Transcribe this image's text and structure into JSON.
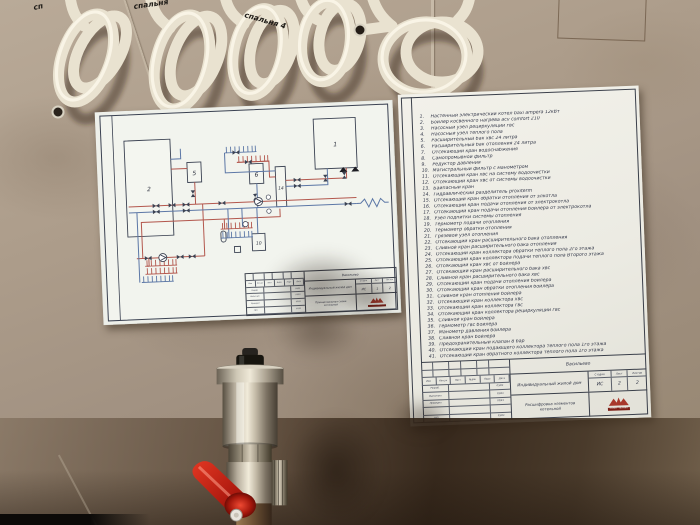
{
  "photo": {
    "cable_labels": [
      "сп",
      "спальня",
      "спальня 4"
    ]
  },
  "colors": {
    "pipe_hot": "#b3574d",
    "pipe_cold": "#5c77a6",
    "schematic_line": "#3b4252",
    "handle_red": "#c0261a",
    "logo_red": "#a8382c",
    "paper": "#efefe9",
    "tile": "#ab9c8a"
  },
  "left_doc": {
    "schematic_labels": {
      "b1": "1",
      "b2": "2",
      "b5": "5",
      "b6": "6",
      "b10": "10",
      "b14": "14"
    },
    "titleblock": {
      "project": "Васильево",
      "object": "Индивидуальный жилой дом",
      "doc_title": "Принципиальная схема котельной",
      "stage_label": "Стадия",
      "sheet_label": "Лист",
      "sheets_label": "Листов",
      "stage": "ИС",
      "sheet": "1",
      "sheets": "2",
      "header_cols": [
        "Изм",
        "Кол.уч",
        "Лист",
        "№док",
        "Подп",
        "Дата"
      ],
      "rows": [
        {
          "role": "Разраб.",
          "date": "03/23"
        },
        {
          "role": "Выполнил",
          "date": "03/23"
        },
        {
          "role": "Проверил",
          "date": "03/23"
        },
        {
          "role": "ГИП",
          "date": "03/23"
        }
      ],
      "logo": "САНКТ-ТЕХНИК"
    }
  },
  "right_doc": {
    "items": [
      "Настенный электрический котел baxi ampera 12кВт",
      "Бойлер косвенного нагрева acv comfort 210",
      "Насосный узел рециркуляции гвс",
      "Насосный узел теплого пола",
      "Расширительный бак хвс 24 литра",
      "Расширительный бак отопления 24 литра",
      "Отсекающий кран водоснабжения",
      "Самопромывной фильтр",
      "Редуктор давления",
      "Магистральный фильтр с манометром",
      "Отсекающий кран хвс на систему водоочистки",
      "Отсекающий кран хвс от системы водоочистки",
      "Байпасный кран",
      "Гидравлический разделитель proxiterm",
      "Отсекающий кран обратки отопления от элкотла",
      "Отсекающий кран подачи отопления от электрокотла",
      "Отсекающий кран подачи отопления бойлера от электрокотла",
      "Узел подпитки системы отопления",
      "Термометр подачи отопления",
      "Термометр обратки отопления",
      "Грязевой узел отопления",
      "Отсекающий кран расширительного бака отопления",
      "Сливной кран расширительного бака отопления",
      "Отсекающий кран коллектора обратки теплого пола 2го этажа",
      "Отсекающий кран коллектора подачи теплого пола Второго этажа",
      "Отсекающий кран хвс от бойлера",
      "Отсекающий кран расширительного бака хвс",
      "Сливной кран расширительного бака хвс",
      "Отсекающий кран подачи отопления бойлера",
      "Отсекающий кран обратки отопления бойлера",
      "Сливной кран отопления бойлера",
      "Отсекающий кран коллектора хвс",
      "Отсекающий кран коллектора гвс",
      "Отсекающий кран коллектора рециркуляции гвс",
      "Сливной кран бойлера",
      "Термометр гвс бойлера",
      "Манометр давления бойлера",
      "Сливной кран бойлера",
      "Предохранительный клапан 8 бар",
      "Отсекающий кран подающего коллектора теплого пола 1го этажа",
      "Отсекающий кран обратного коллектора теплого пола 1го этажа"
    ],
    "titleblock": {
      "project": "Васильево",
      "object": "Индивидуальный жилой дом",
      "doc_title": "Расшифровка элементов котельной",
      "stage_label": "Стадия",
      "sheet_label": "Лист",
      "sheets_label": "Листов",
      "stage": "ИС",
      "sheet": "2",
      "sheets": "2",
      "header_cols": [
        "Изм",
        "Кол.уч",
        "Лист",
        "№док",
        "Подп",
        "Дата"
      ],
      "rows": [
        {
          "role": "Разраб.",
          "date": "03/23"
        },
        {
          "role": "Выполнил",
          "date": "03/23"
        },
        {
          "role": "Проверил",
          "date": "03/23"
        },
        {
          "role": "ГИП",
          "date": "03/23"
        }
      ],
      "logo": "САНКТ-ТЕХНИК"
    }
  }
}
